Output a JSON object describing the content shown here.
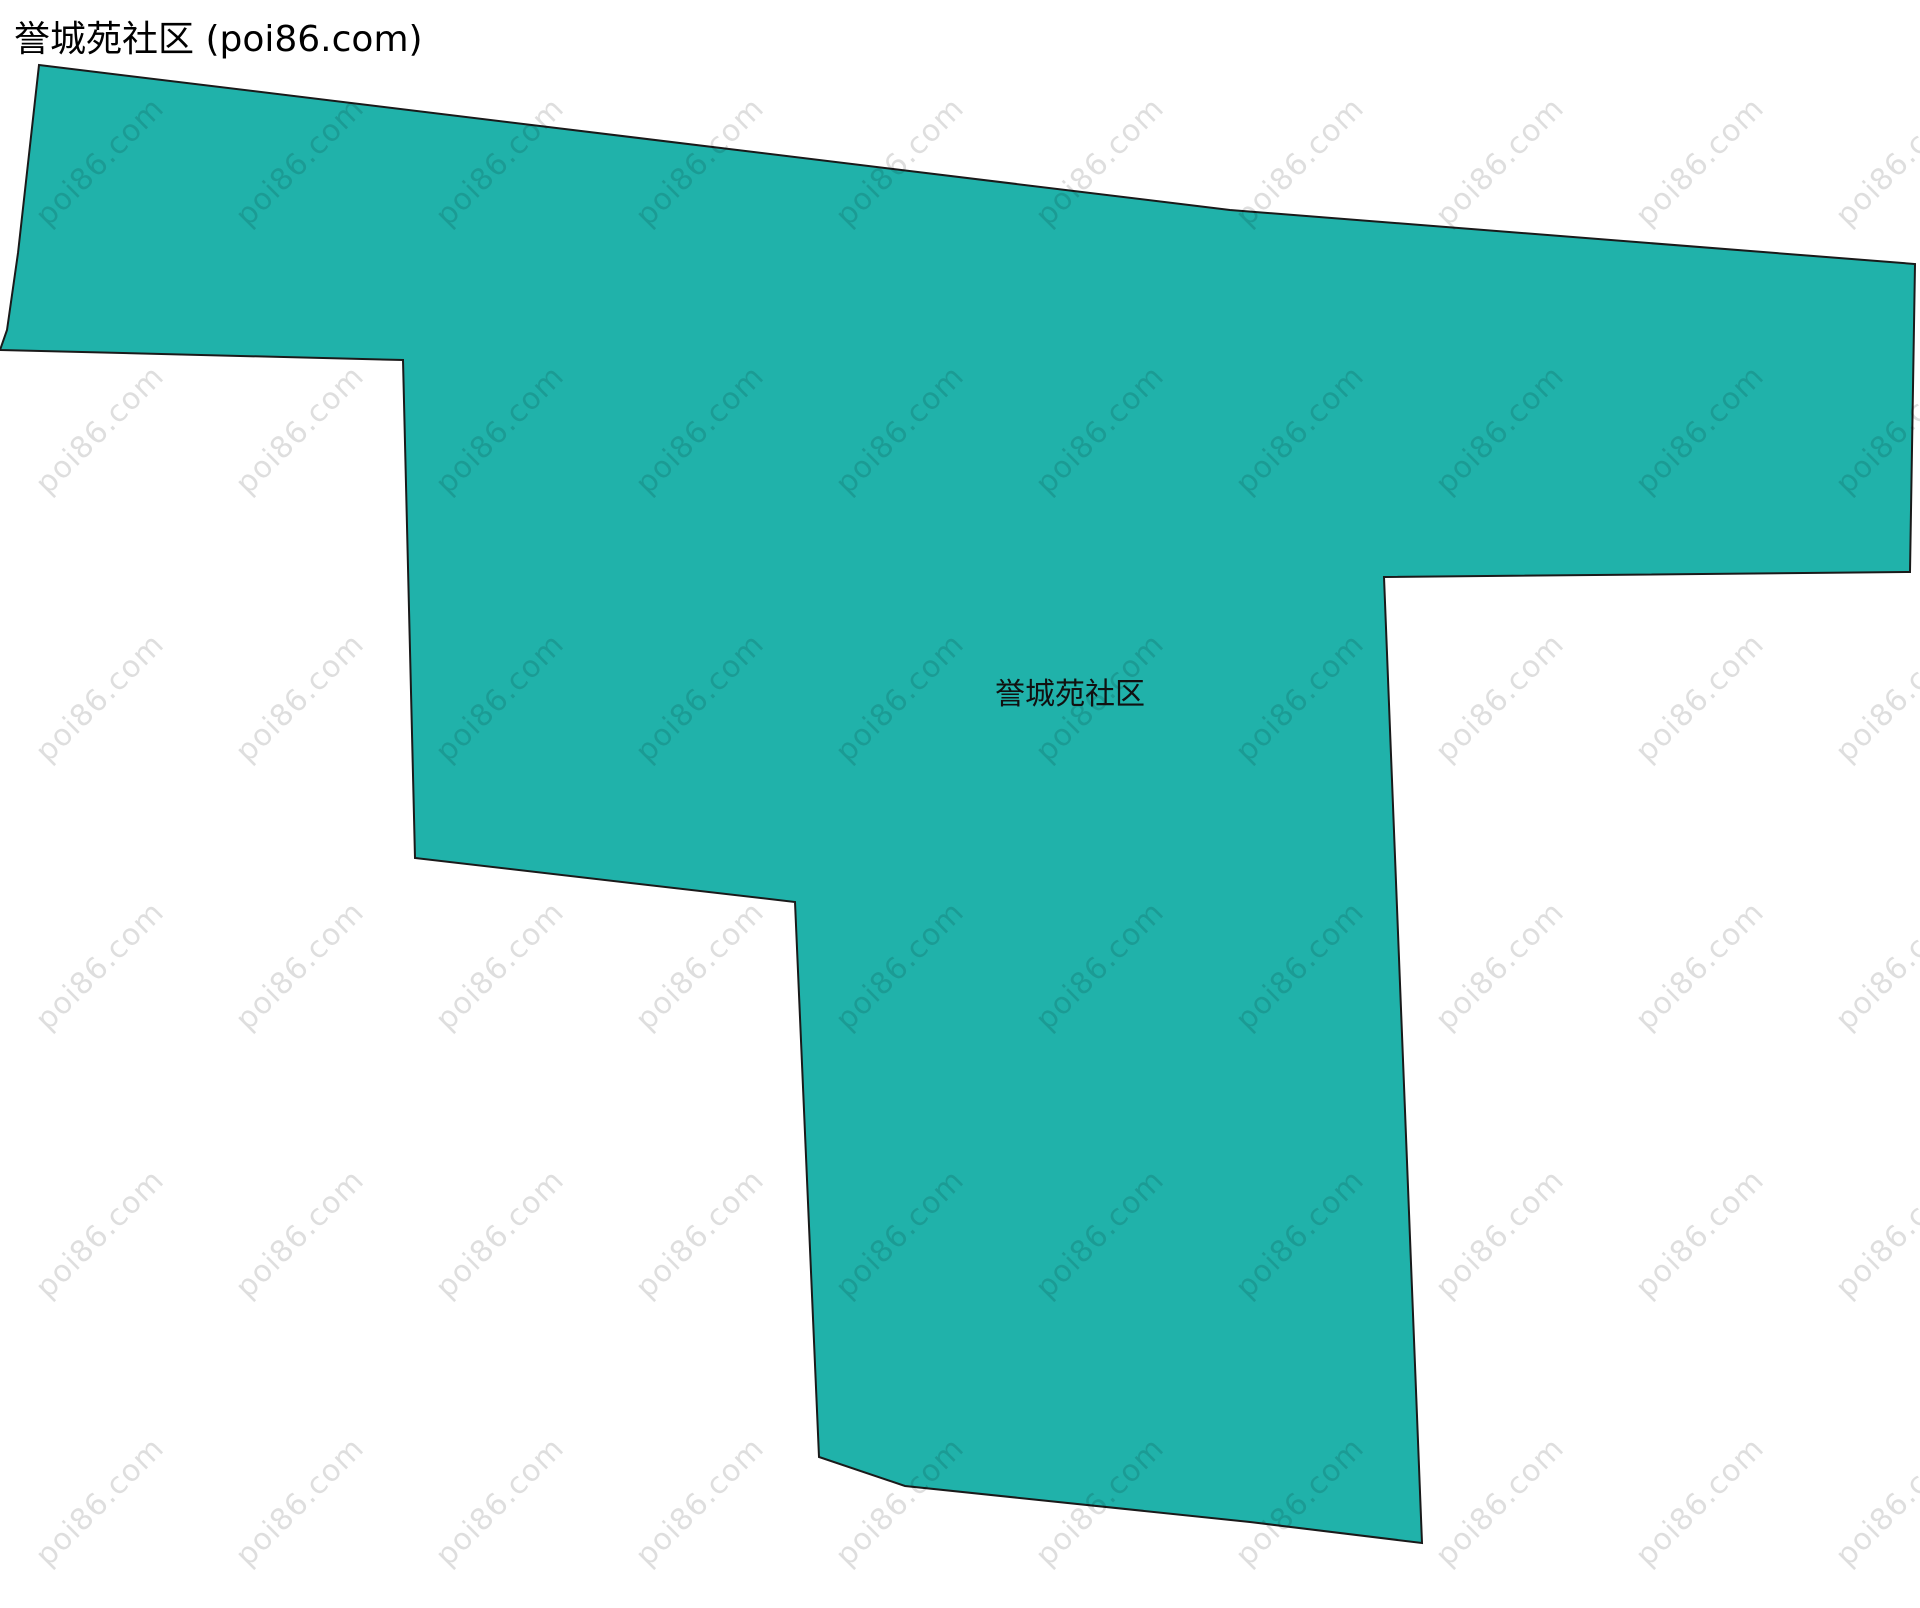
{
  "header": {
    "title": "誉城苑社区 (poi86.com)",
    "color": "#000000"
  },
  "map": {
    "region_name": "誉城苑社区",
    "fill_color": "#20b2aa",
    "stroke_color": "#1a1a1a",
    "stroke_width": 2,
    "label": {
      "text": "誉城苑社区",
      "x": 1070,
      "y": 691,
      "color": "#111111"
    },
    "polygon_points": [
      [
        39,
        65
      ],
      [
        1230,
        210
      ],
      [
        1915,
        264
      ],
      [
        1910,
        572
      ],
      [
        1384,
        577
      ],
      [
        1422,
        1543
      ],
      [
        1250,
        1522
      ],
      [
        905,
        1486
      ],
      [
        819,
        1457
      ],
      [
        795,
        902
      ],
      [
        415,
        858
      ],
      [
        403,
        360
      ],
      [
        0,
        350
      ],
      [
        7,
        330
      ],
      [
        18,
        253
      ]
    ]
  },
  "watermark": {
    "text": "poi86.com",
    "color": "rgba(0, 0, 0, 0.13)"
  }
}
